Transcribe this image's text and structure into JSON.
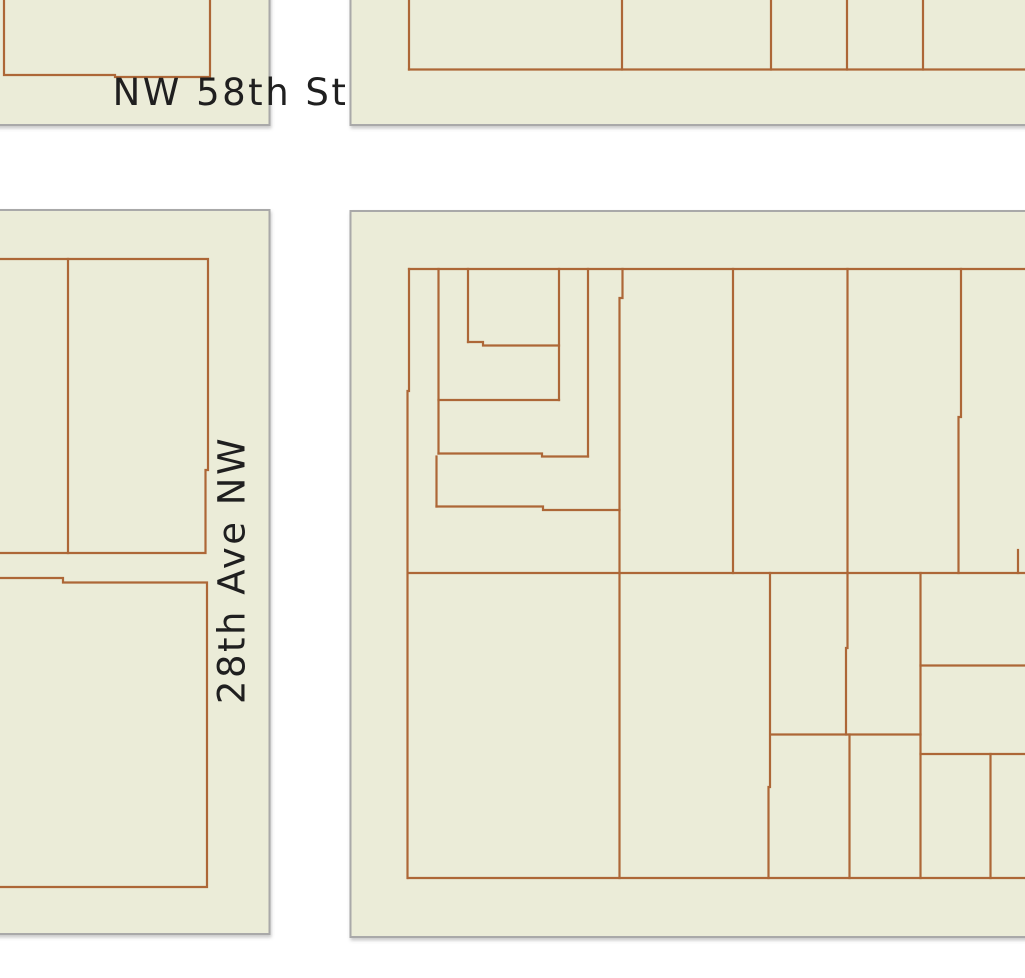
{
  "map": {
    "background_color": "#ffffff",
    "block_fill_color": "#ebecd8",
    "block_border_color": "#a9a9a9",
    "parcel_line_color": "#ad6737",
    "label_color": "#1f1f1f",
    "labels": [
      {
        "id": "nw-58th-st",
        "text": "NW 58th St",
        "x": 230.5,
        "y": 92.5,
        "rotation": 0
      },
      {
        "id": "28th-ave-nw",
        "text": "28th Ave NW",
        "x": 232,
        "y": 570,
        "rotation": -90
      }
    ],
    "blocks": [
      {
        "id": "northwest",
        "x": -8,
        "y": -8,
        "w": 277.5,
        "h": 133
      },
      {
        "id": "northeast",
        "x": 350.5,
        "y": -8,
        "w": 682.5,
        "h": 133
      },
      {
        "id": "southwest",
        "x": -8,
        "y": 210,
        "w": 277.5,
        "h": 724
      },
      {
        "id": "southeast",
        "x": 350.5,
        "y": 211,
        "w": 682.5,
        "h": 726
      }
    ],
    "parcel_lines": [
      {
        "block": "northwest",
        "points": [
          [
            4,
            -8
          ],
          [
            4,
            75
          ],
          [
            115,
            75
          ],
          [
            115,
            77
          ],
          [
            210,
            77
          ],
          [
            210,
            -8
          ]
        ]
      },
      {
        "block": "northeast",
        "points": [
          [
            409,
            -8
          ],
          [
            409,
            69.5
          ]
        ]
      },
      {
        "block": "northeast",
        "points": [
          [
            622,
            -8
          ],
          [
            622,
            69.5
          ]
        ]
      },
      {
        "block": "northeast",
        "points": [
          [
            771,
            -8
          ],
          [
            771,
            69.5
          ]
        ]
      },
      {
        "block": "northeast",
        "points": [
          [
            847,
            -8
          ],
          [
            847,
            69.5
          ]
        ]
      },
      {
        "block": "northeast",
        "points": [
          [
            923,
            -8
          ],
          [
            923,
            69.5
          ]
        ]
      },
      {
        "block": "northeast",
        "points": [
          [
            409,
            69.5
          ],
          [
            1033,
            69.5
          ]
        ]
      },
      {
        "block": "southwest",
        "points": [
          [
            -8,
            259
          ],
          [
            208,
            259
          ],
          [
            208,
            470
          ],
          [
            205.5,
            470
          ],
          [
            205.5,
            553
          ],
          [
            -8,
            553
          ]
        ]
      },
      {
        "block": "southwest",
        "points": [
          [
            68,
            259
          ],
          [
            68,
            553
          ]
        ]
      },
      {
        "block": "southwest",
        "points": [
          [
            -8,
            578
          ],
          [
            63,
            578
          ],
          [
            63,
            582.5
          ],
          [
            207,
            582.5
          ],
          [
            207,
            887
          ],
          [
            -8,
            887
          ]
        ]
      },
      {
        "block": "southeast",
        "points": [
          [
            409,
            269
          ],
          [
            1033,
            269
          ]
        ]
      },
      {
        "block": "southeast",
        "points": [
          [
            408,
            573
          ],
          [
            1033,
            573
          ]
        ]
      },
      {
        "block": "southeast",
        "points": [
          [
            408,
            878
          ],
          [
            1033,
            878
          ]
        ]
      },
      {
        "block": "southeast",
        "points": [
          [
            409,
            269
          ],
          [
            409,
            391
          ],
          [
            407.5,
            391
          ],
          [
            407.5,
            878
          ]
        ]
      },
      {
        "block": "southeast",
        "points": [
          [
            438.5,
            269
          ],
          [
            438.5,
            453.5
          ]
        ]
      },
      {
        "block": "southeast",
        "points": [
          [
            436.5,
            456.5
          ],
          [
            436.5,
            506.5
          ]
        ]
      },
      {
        "block": "southeast",
        "points": [
          [
            468,
            269
          ],
          [
            468,
            342
          ]
        ]
      },
      {
        "block": "southeast",
        "points": [
          [
            468,
            342
          ],
          [
            483,
            342
          ],
          [
            483,
            345.5
          ],
          [
            559,
            345.5
          ]
        ]
      },
      {
        "block": "southeast",
        "points": [
          [
            559,
            269
          ],
          [
            559,
            400
          ]
        ]
      },
      {
        "block": "southeast",
        "points": [
          [
            438.5,
            400
          ],
          [
            559,
            400
          ]
        ]
      },
      {
        "block": "southeast",
        "points": [
          [
            588,
            269
          ],
          [
            588,
            456.5
          ]
        ]
      },
      {
        "block": "southeast",
        "points": [
          [
            438.5,
            453.5
          ],
          [
            542,
            453.5
          ],
          [
            542,
            456.5
          ],
          [
            588,
            456.5
          ]
        ]
      },
      {
        "block": "southeast",
        "points": [
          [
            622.5,
            269
          ],
          [
            622.5,
            298
          ],
          [
            619.5,
            298
          ],
          [
            619.5,
            878
          ]
        ]
      },
      {
        "block": "southeast",
        "points": [
          [
            436.5,
            506.5
          ],
          [
            543,
            506.5
          ],
          [
            543,
            510
          ],
          [
            619.5,
            510
          ]
        ]
      },
      {
        "block": "southeast",
        "points": [
          [
            733,
            269
          ],
          [
            733,
            573
          ]
        ]
      },
      {
        "block": "southeast",
        "points": [
          [
            847.5,
            269
          ],
          [
            847.5,
            573
          ]
        ]
      },
      {
        "block": "southeast",
        "points": [
          [
            961,
            269
          ],
          [
            961,
            417
          ],
          [
            958.5,
            417
          ],
          [
            958.5,
            573
          ]
        ]
      },
      {
        "block": "southeast",
        "points": [
          [
            1018,
            550
          ],
          [
            1018,
            573
          ]
        ]
      },
      {
        "block": "southeast",
        "points": [
          [
            770,
            573
          ],
          [
            770,
            787
          ],
          [
            768.5,
            787
          ],
          [
            768.5,
            878
          ]
        ]
      },
      {
        "block": "southeast",
        "points": [
          [
            847.5,
            573
          ],
          [
            847.5,
            648
          ],
          [
            846,
            648
          ],
          [
            846,
            734.5
          ]
        ]
      },
      {
        "block": "southeast",
        "points": [
          [
            771,
            734.5
          ],
          [
            920.5,
            734.5
          ]
        ]
      },
      {
        "block": "southeast",
        "points": [
          [
            849.5,
            734.5
          ],
          [
            849.5,
            878
          ]
        ]
      },
      {
        "block": "southeast",
        "points": [
          [
            920.5,
            573
          ],
          [
            920.5,
            878
          ]
        ]
      },
      {
        "block": "southeast",
        "points": [
          [
            920.5,
            665.5
          ],
          [
            1033,
            665.5
          ]
        ]
      },
      {
        "block": "southeast",
        "points": [
          [
            920.5,
            754
          ],
          [
            1033,
            754
          ]
        ]
      },
      {
        "block": "southeast",
        "points": [
          [
            990.5,
            754
          ],
          [
            990.5,
            878
          ]
        ]
      }
    ]
  }
}
